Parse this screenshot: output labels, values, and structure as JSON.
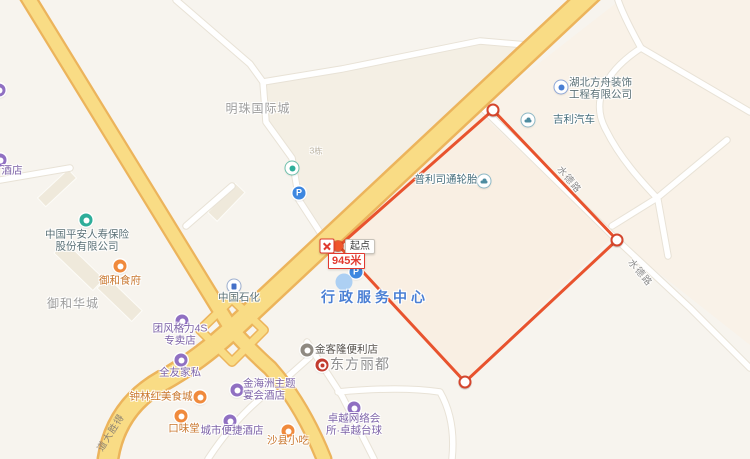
{
  "colors": {
    "route": "#E8532E",
    "main_road": "#F9DC85",
    "road_casing": "#ECB45C"
  },
  "route": {
    "color": "#E8532E",
    "points": [
      [
        339,
        246
      ],
      [
        493,
        110
      ],
      [
        617,
        240
      ],
      [
        465,
        382
      ]
    ],
    "closed": true,
    "waypoints": [
      [
        493,
        110
      ],
      [
        617,
        240
      ],
      [
        465,
        382
      ]
    ],
    "start": {
      "x": 338,
      "y": 246,
      "label": "起点",
      "distance": "945米"
    }
  },
  "road_labels": [
    {
      "name": "road-label-shuidelu-1",
      "text": "水德路",
      "x": 570,
      "y": 179,
      "rot": 50
    },
    {
      "name": "road-label-shuidelu-2",
      "text": "水德路",
      "x": 641,
      "y": 272,
      "rot": 50
    },
    {
      "name": "road-label-deshengdadao",
      "text": "得胜大道",
      "x": 110,
      "y": 432,
      "rot": -58,
      "reverse": true,
      "onroad": true
    }
  ],
  "area_labels": [
    {
      "name": "area-label-mingzhu",
      "text": "明珠国际城",
      "x": 258,
      "y": 108,
      "size": 12,
      "color": "#9D9D9D",
      "ls": 1
    },
    {
      "name": "area-label-yuhehuacheng",
      "text": "御和华城",
      "x": 73,
      "y": 303,
      "size": 12,
      "color": "#9D9D9D",
      "ls": 1
    },
    {
      "name": "area-label-dongfanglidu",
      "text": "东方丽都",
      "x": 360,
      "y": 364,
      "size": 14,
      "color": "#8F8F8F",
      "ls": 1
    },
    {
      "name": "label-xingzheng-center",
      "text": "行政服务中心",
      "x": 375,
      "y": 297,
      "size": 14,
      "color": "#4A7FD4",
      "ls": 4,
      "bold": true
    },
    {
      "name": "label-building-no",
      "text": "3栋",
      "x": 316,
      "y": 151,
      "size": 8,
      "color": "#B8B09F",
      "ls": 0
    }
  ],
  "pois": [
    {
      "name": "pingan-insurance",
      "icon": "company-poi-icon",
      "cat": "teal",
      "ix": 86,
      "iy": 220,
      "label": [
        "中国平安人寿保险",
        "股份有限公司"
      ],
      "lx": 87,
      "ly": 241,
      "lcat": "company"
    },
    {
      "name": "green-poi",
      "icon": "leaf-icon",
      "cat": "leaf",
      "ix": 292,
      "iy": 168
    },
    {
      "name": "parking-mingzhu",
      "icon": "parking-icon",
      "cat": "parking",
      "ix": 299,
      "iy": 193,
      "glyph": "P"
    },
    {
      "name": "bridgestone-tyres",
      "icon": "car-dealer-icon",
      "cat": "car",
      "ix": 484,
      "iy": 181,
      "label": [
        "普利司通轮胎"
      ],
      "lx": 446,
      "ly": 180,
      "lcat": "auto"
    },
    {
      "name": "geely-auto",
      "icon": "car-dealer-icon",
      "cat": "car",
      "ix": 528,
      "iy": 120,
      "label": [
        "吉利汽车"
      ],
      "lx": 553,
      "ly": 120,
      "lcat": "auto",
      "align": "left"
    },
    {
      "name": "hubei-fangzhou-decoration",
      "icon": "company-poi-icon",
      "cat": "blue-dot",
      "ix": 561,
      "iy": 87,
      "label": [
        "湖北方舟装饰",
        "工程有限公司"
      ],
      "lx": 569,
      "ly": 89,
      "lcat": "company",
      "align": "left"
    },
    {
      "name": "sinopec",
      "icon": "gas-station-icon",
      "cat": "gas",
      "ix": 234,
      "iy": 286,
      "label": [
        "中国石化"
      ],
      "lx": 239,
      "ly": 298,
      "lcat": "company"
    },
    {
      "name": "parking-xingzheng",
      "icon": "parking-icon",
      "cat": "parking",
      "ix": 356,
      "iy": 272,
      "glyph": "P"
    },
    {
      "name": "xingzheng-poi-dot",
      "icon": "poi-dot-icon",
      "cat": "dot",
      "ix": 344,
      "iy": 282
    },
    {
      "name": "yuhe-restaurant",
      "icon": "restaurant-icon",
      "cat": "orange",
      "ix": 120,
      "iy": 266,
      "label": [
        "御和食府"
      ],
      "lx": 120,
      "ly": 281,
      "lcat": "orange"
    },
    {
      "name": "gree-4s-store",
      "icon": "shop-icon",
      "cat": "purple",
      "ix": 182,
      "iy": 321,
      "label": [
        "团风格力4S",
        "专卖店"
      ],
      "lx": 180,
      "ly": 335,
      "lcat": "purple"
    },
    {
      "name": "quanyou-furniture",
      "icon": "shop-icon",
      "cat": "purple",
      "ix": 181,
      "iy": 360,
      "label": [
        "全友家私"
      ],
      "lx": 180,
      "ly": 373,
      "lcat": "purple"
    },
    {
      "name": "zhonglinhong-foodcity",
      "icon": "restaurant-icon",
      "cat": "orange",
      "ix": 200,
      "iy": 397,
      "label": [
        "钟林红美食城"
      ],
      "lx": 161,
      "ly": 397,
      "lcat": "orange"
    },
    {
      "name": "jinhaizhou-hotel",
      "icon": "hotel-icon",
      "cat": "purple",
      "ix": 237,
      "iy": 390,
      "label": [
        "金海洲主题",
        "宴会酒店"
      ],
      "lx": 243,
      "ly": 390,
      "lcat": "purple",
      "align": "left"
    },
    {
      "name": "kouweitang",
      "icon": "restaurant-icon",
      "cat": "orange",
      "ix": 181,
      "iy": 416,
      "label": [
        "口味堂"
      ],
      "lx": 184,
      "ly": 429,
      "lcat": "orange"
    },
    {
      "name": "city-comfort-inn",
      "icon": "hotel-icon",
      "cat": "purple",
      "ix": 230,
      "iy": 421,
      "label": [
        "城市便捷酒店"
      ],
      "lx": 232,
      "ly": 431,
      "lcat": "purple"
    },
    {
      "name": "shaxian-snacks",
      "icon": "restaurant-icon",
      "cat": "orange",
      "ix": 288,
      "iy": 431,
      "label": [
        "沙县小吃"
      ],
      "lx": 288,
      "ly": 441,
      "lcat": "orange"
    },
    {
      "name": "jinkelong-store",
      "icon": "convenience-store-icon",
      "cat": "gray",
      "ix": 307,
      "iy": 350,
      "label": [
        "金客隆便利店"
      ],
      "lx": 315,
      "ly": 350,
      "lcat": "dark",
      "align": "left"
    },
    {
      "name": "dongfanglidu-poi",
      "icon": "landmark-icon",
      "cat": "target",
      "ix": 322,
      "iy": 365
    },
    {
      "name": "zhuoyue-club",
      "icon": "internet-cafe-icon",
      "cat": "purple",
      "ix": 354,
      "iy": 408,
      "label": [
        "卓越网络会",
        "所·卓越台球"
      ],
      "lx": 354,
      "ly": 425,
      "lcat": "purple"
    },
    {
      "name": "hotel-left-edge",
      "icon": "hotel-icon",
      "cat": "purple",
      "ix": 0,
      "iy": 160,
      "label": [
        "酒店"
      ],
      "lx": 12,
      "ly": 171,
      "lcat": "purple"
    },
    {
      "name": "edge-poi-topleft",
      "icon": "poi-icon",
      "cat": "purple",
      "ix": -1,
      "iy": 90
    }
  ]
}
